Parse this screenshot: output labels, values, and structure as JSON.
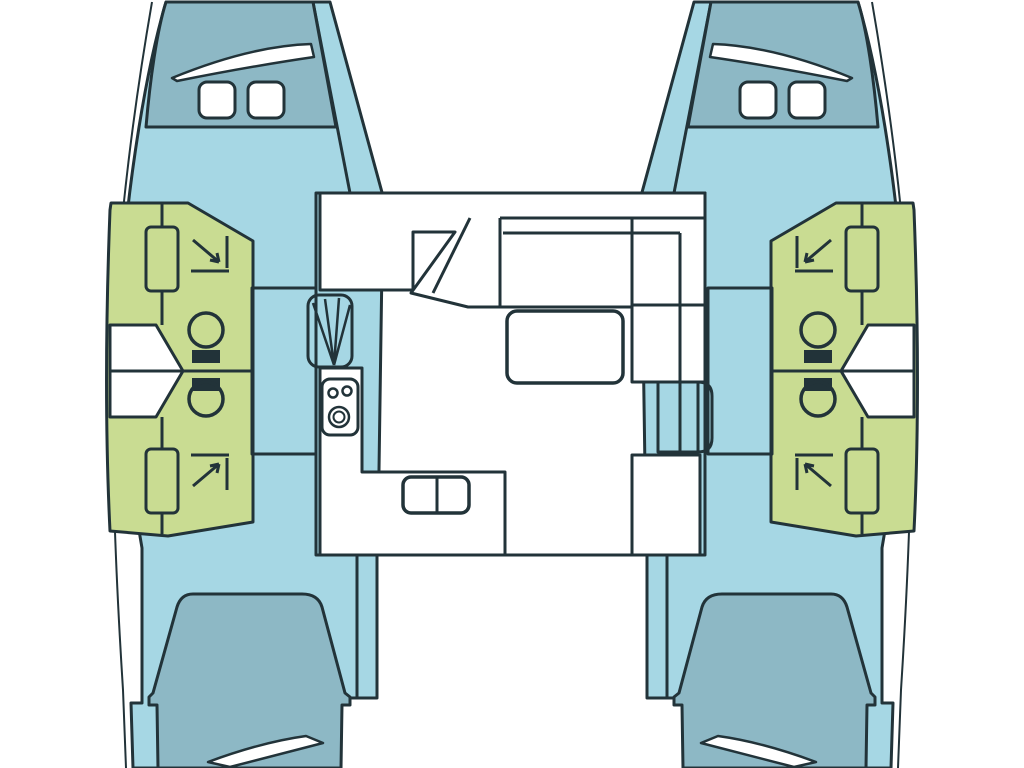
{
  "colors": {
    "background": "#ffffff",
    "outline": "#223339",
    "hull": "#a6d7e4",
    "foredeck": "#8db8c5",
    "cabin_green": "#c9dc92",
    "salon_yellow": "#f9d68c",
    "white_fill": "#ffffff"
  },
  "symbols": {
    "shower": "corner-arrow-icon",
    "toilet": "bowl-circle-with-cistern-icon",
    "stove": "two-burner-with-oven-ring-icon",
    "sink": "double-basin-icon",
    "hatch": "rounded-square-icon",
    "window": "curved-sliver-icon",
    "stairs": "fan-steps-icon"
  }
}
